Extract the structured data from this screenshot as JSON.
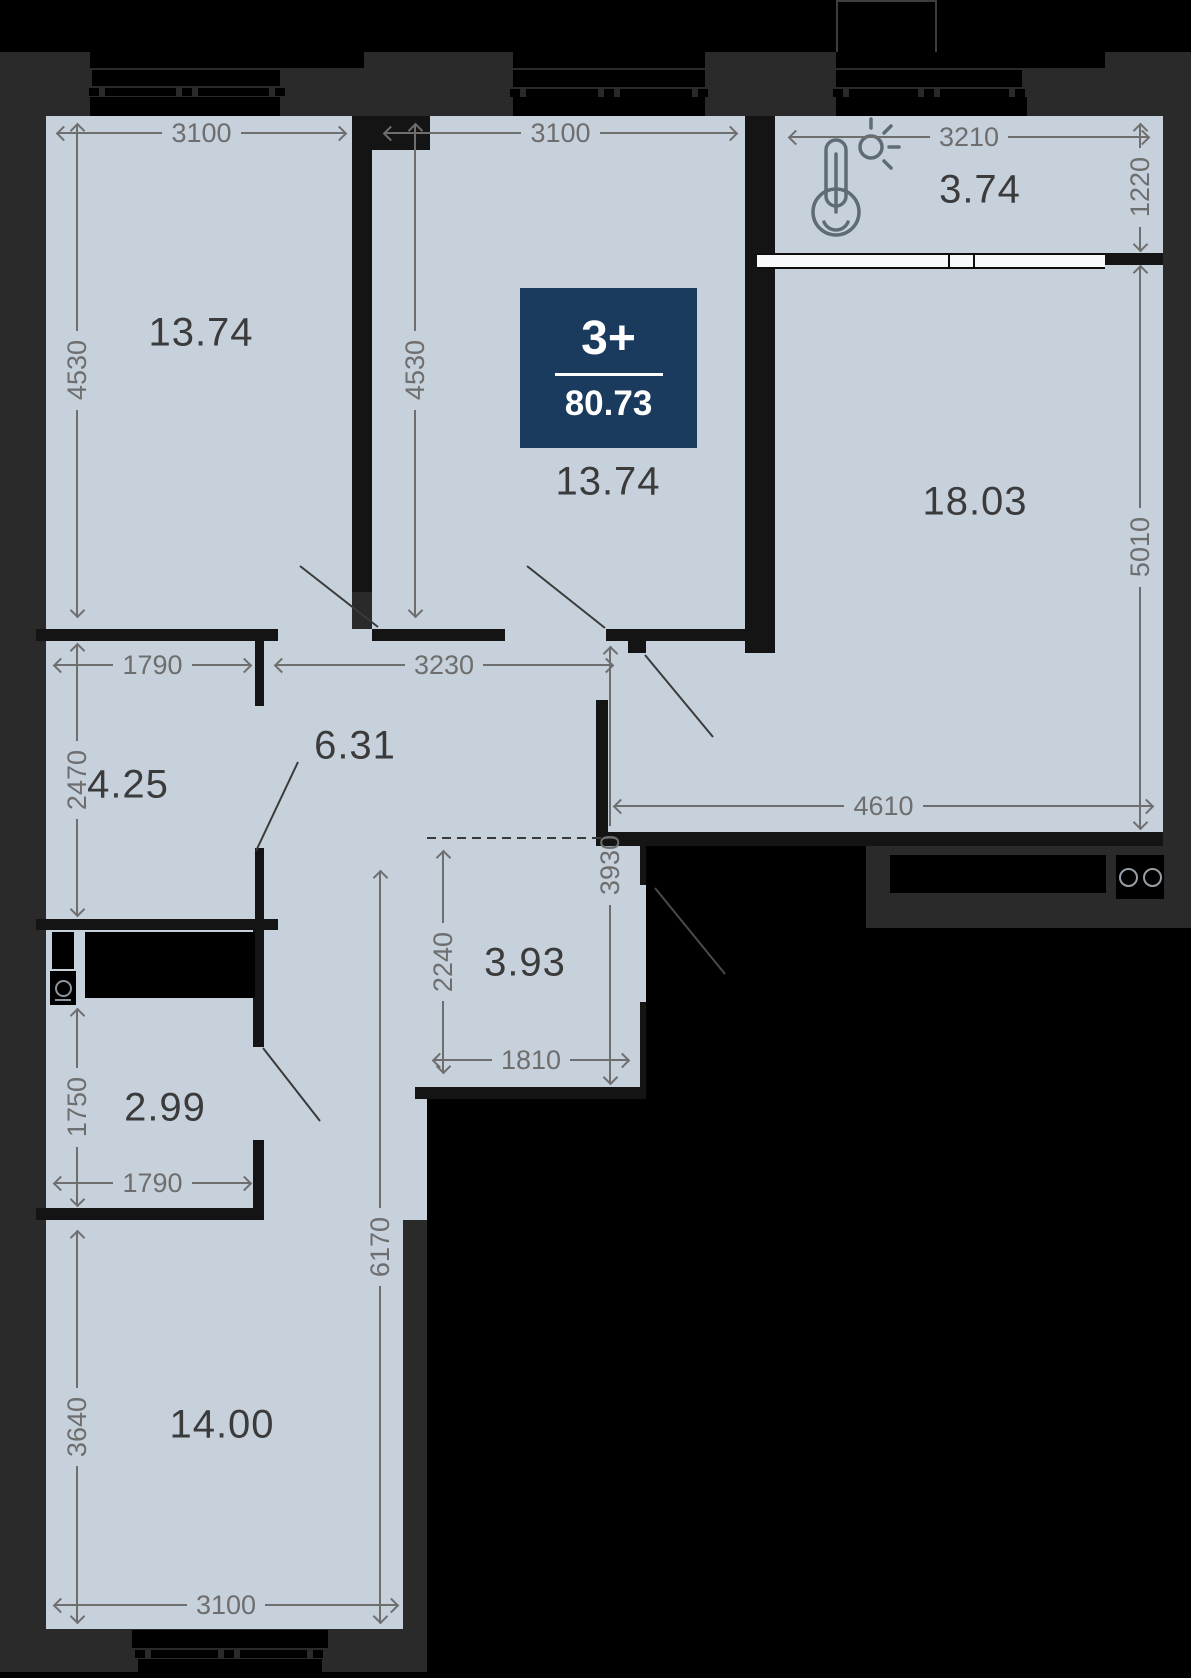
{
  "plan": {
    "badge": {
      "rooms_label": "3+",
      "total_area": "80.73"
    },
    "rooms": [
      {
        "name": "bedroom-top-left",
        "area": "13.74"
      },
      {
        "name": "bedroom-top-center",
        "area": "13.74"
      },
      {
        "name": "balcony",
        "area": "3.74"
      },
      {
        "name": "living-kitchen",
        "area": "18.03"
      },
      {
        "name": "corridor",
        "area": "4.25"
      },
      {
        "name": "hallway",
        "area": "6.31"
      },
      {
        "name": "wardrobe-niche",
        "area": "3.93"
      },
      {
        "name": "bathroom",
        "area": "2.99"
      },
      {
        "name": "bedroom-bottom",
        "area": "14.00"
      }
    ],
    "dimensions": [
      {
        "label": "3100",
        "dir": "h",
        "x": 58,
        "y": 133,
        "len": 287
      },
      {
        "label": "4530",
        "dir": "v",
        "x": 77,
        "y": 125,
        "len": 491
      },
      {
        "label": "3100",
        "dir": "h",
        "x": 385,
        "y": 133,
        "len": 351
      },
      {
        "label": "4530",
        "dir": "v",
        "x": 415,
        "y": 125,
        "len": 491
      },
      {
        "label": "3210",
        "dir": "h",
        "x": 790,
        "y": 137,
        "len": 358
      },
      {
        "label": "1220",
        "dir": "v",
        "x": 1140,
        "y": 125,
        "len": 125
      },
      {
        "label": "5010",
        "dir": "v",
        "x": 1140,
        "y": 267,
        "len": 561
      },
      {
        "label": "4610",
        "dir": "h",
        "x": 615,
        "y": 806,
        "len": 537
      },
      {
        "label": "3930",
        "dir": "v",
        "x": 610,
        "y": 648,
        "len": 435
      },
      {
        "label": "3230",
        "dir": "h",
        "x": 276,
        "y": 665,
        "len": 336
      },
      {
        "label": "1790",
        "dir": "h",
        "x": 55,
        "y": 665,
        "len": 195
      },
      {
        "label": "2470",
        "dir": "v",
        "x": 77,
        "y": 645,
        "len": 270
      },
      {
        "label": "2240",
        "dir": "v",
        "x": 443,
        "y": 852,
        "len": 220
      },
      {
        "label": "1810",
        "dir": "h",
        "x": 434,
        "y": 1060,
        "len": 194
      },
      {
        "label": "1750",
        "dir": "v",
        "x": 77,
        "y": 1010,
        "len": 195
      },
      {
        "label": "1790",
        "dir": "h",
        "x": 55,
        "y": 1183,
        "len": 195
      },
      {
        "label": "3640",
        "dir": "v",
        "x": 77,
        "y": 1232,
        "len": 390
      },
      {
        "label": "6170",
        "dir": "v",
        "x": 380,
        "y": 872,
        "len": 750
      },
      {
        "label": "3100",
        "dir": "h",
        "x": 55,
        "y": 1605,
        "len": 342
      }
    ],
    "icons": [
      "thermometer-icon",
      "stove-icon",
      "washing-machine-icon"
    ],
    "colors": {
      "background": "#2a2a2a",
      "room_fill": "#c7d1dc",
      "wall": "#141414",
      "badge": "#1a3a5e",
      "dimension_text": "#6e6e6e",
      "area_text": "#3b3b3b",
      "window": "#f7f9fa"
    }
  }
}
